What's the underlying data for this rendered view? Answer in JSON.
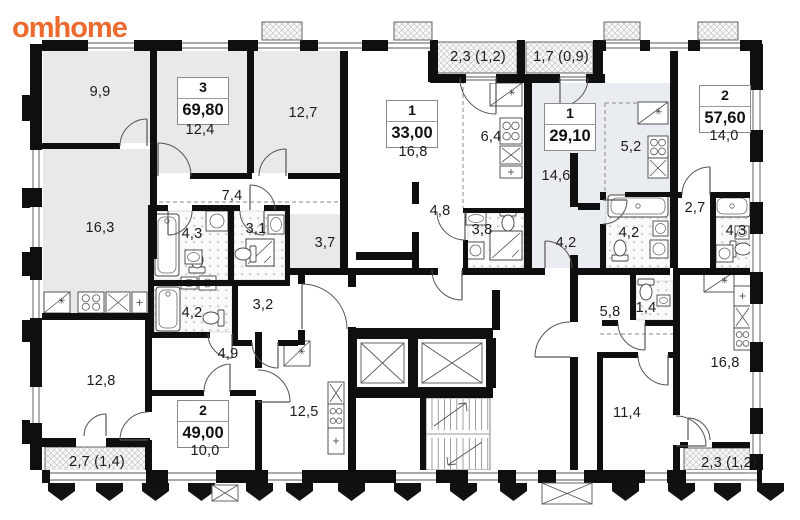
{
  "logo": {
    "part1": "om",
    "part2": "home",
    "color1": "#ed6a2f",
    "color2": "#ed6a2f"
  },
  "apartments": [
    {
      "rooms": "3",
      "area": "69,80"
    },
    {
      "rooms": "1",
      "area": "33,00"
    },
    {
      "rooms": "1",
      "area": "29,10"
    },
    {
      "rooms": "2",
      "area": "57,60"
    },
    {
      "rooms": "2",
      "area": "49,00"
    }
  ],
  "room_labels": [
    {
      "t": "9,9",
      "x": 100,
      "y": 92
    },
    {
      "t": "12,4",
      "x": 200,
      "y": 130
    },
    {
      "t": "12,7",
      "x": 303,
      "y": 113
    },
    {
      "t": "16,3",
      "x": 100,
      "y": 228
    },
    {
      "t": "7,4",
      "x": 232,
      "y": 196
    },
    {
      "t": "4,3",
      "x": 192,
      "y": 234
    },
    {
      "t": "3,1",
      "x": 256,
      "y": 229
    },
    {
      "t": "3,7",
      "x": 325,
      "y": 243
    },
    {
      "t": "4,2",
      "x": 192,
      "y": 313
    },
    {
      "t": "3,2",
      "x": 263,
      "y": 305
    },
    {
      "t": "4,9",
      "x": 228,
      "y": 354
    },
    {
      "t": "12,8",
      "x": 101,
      "y": 381
    },
    {
      "t": "10,0",
      "x": 205,
      "y": 451
    },
    {
      "t": "12,5",
      "x": 304,
      "y": 412
    },
    {
      "t": "2,7 (1,4)",
      "x": 97,
      "y": 462
    },
    {
      "t": "16,8",
      "x": 413,
      "y": 152
    },
    {
      "t": "6,4",
      "x": 491,
      "y": 137
    },
    {
      "t": "4,8",
      "x": 440,
      "y": 211
    },
    {
      "t": "3,8",
      "x": 482,
      "y": 230
    },
    {
      "t": "2,3 (1,2)",
      "x": 478,
      "y": 57
    },
    {
      "t": "1,7 (0,9)",
      "x": 561,
      "y": 57
    },
    {
      "t": "14,6",
      "x": 556,
      "y": 176
    },
    {
      "t": "5,2",
      "x": 631,
      "y": 147
    },
    {
      "t": "4,2",
      "x": 566,
      "y": 243
    },
    {
      "t": "4,2",
      "x": 629,
      "y": 233
    },
    {
      "t": "14,0",
      "x": 724,
      "y": 136
    },
    {
      "t": "2,7",
      "x": 695,
      "y": 208
    },
    {
      "t": "4,3",
      "x": 736,
      "y": 231
    },
    {
      "t": "5,8",
      "x": 610,
      "y": 312
    },
    {
      "t": "1,4",
      "x": 646,
      "y": 308
    },
    {
      "t": "11,4",
      "x": 627,
      "y": 413
    },
    {
      "t": "16,8",
      "x": 725,
      "y": 363
    },
    {
      "t": "2,3 (1,2)",
      "x": 729,
      "y": 463
    }
  ],
  "icons": {
    "fridge_mark": "✳"
  }
}
